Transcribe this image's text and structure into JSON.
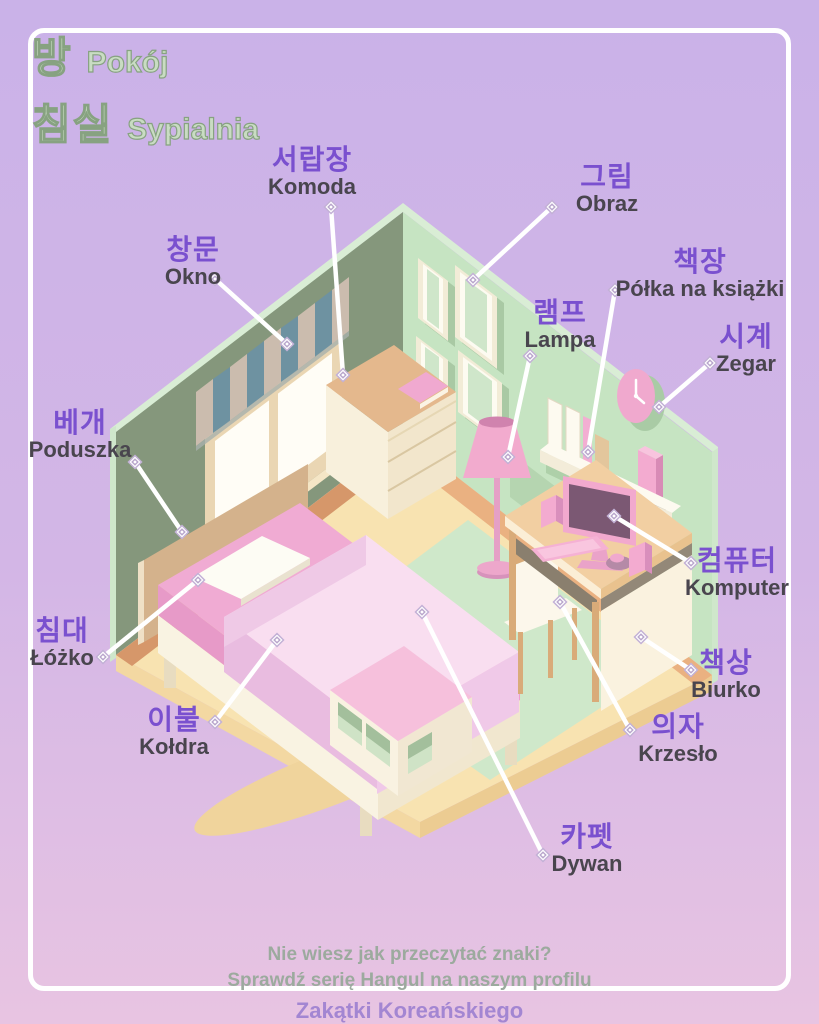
{
  "title": {
    "korean_line1": "방",
    "polish_line1": "Pokój",
    "korean_line2": "침실",
    "polish_line2": "Sypialnia"
  },
  "labels": [
    {
      "id": "dresser",
      "korean": "서랍장",
      "polish": "Komoda"
    },
    {
      "id": "picture",
      "korean": "그림",
      "polish": "Obraz"
    },
    {
      "id": "window",
      "korean": "창문",
      "polish": "Okno"
    },
    {
      "id": "bookshelf",
      "korean": "책장",
      "polish": "Półka na książki"
    },
    {
      "id": "lamp",
      "korean": "램프",
      "polish": "Lampa"
    },
    {
      "id": "clock",
      "korean": "시계",
      "polish": "Zegar"
    },
    {
      "id": "pillow",
      "korean": "베개",
      "polish": "Poduszka"
    },
    {
      "id": "bed",
      "korean": "침대",
      "polish": "Łóżko"
    },
    {
      "id": "duvet",
      "korean": "이불",
      "polish": "Kołdra"
    },
    {
      "id": "carpet",
      "korean": "카펫",
      "polish": "Dywan"
    },
    {
      "id": "computer",
      "korean": "컴퓨터",
      "polish": "Komputer"
    },
    {
      "id": "desk",
      "korean": "책상",
      "polish": "Biurko"
    },
    {
      "id": "chair",
      "korean": "의자",
      "polish": "Krzesło"
    }
  ],
  "footer": {
    "line1": "Nie wiesz jak przeczytać znaki?",
    "line2": "Sprawdź serię Hangul na naszym profilu",
    "brand": "Zakątki Koreańskiego"
  },
  "colors": {
    "korean_text": "#7a50cf",
    "polish_text": "#49454e",
    "title_green": "#c9dcc3",
    "title_outline": "#87a281",
    "footer_text": "#9caa9e",
    "brand_text": "#a386d2",
    "background_top": "#cab2e8",
    "background_bottom": "#e8c4e2",
    "frame_border": "#ffffff",
    "connector": "#ffffff",
    "wall_left": "#85977c",
    "wall_right": "#c6e4c2",
    "floor": "#f8e3b1",
    "carpet": "#cfe8ca",
    "furniture_pink": "#f2abce"
  },
  "scene_objects": [
    "window",
    "striped-blind",
    "picture-frames",
    "dresser",
    "floor-lamp",
    "wall-shelf",
    "books",
    "candle",
    "clock",
    "desk",
    "monitor",
    "keyboard",
    "mouse",
    "speakers",
    "chair",
    "bed",
    "headboard",
    "pillow",
    "duvet",
    "cube-storage",
    "carpet"
  ]
}
